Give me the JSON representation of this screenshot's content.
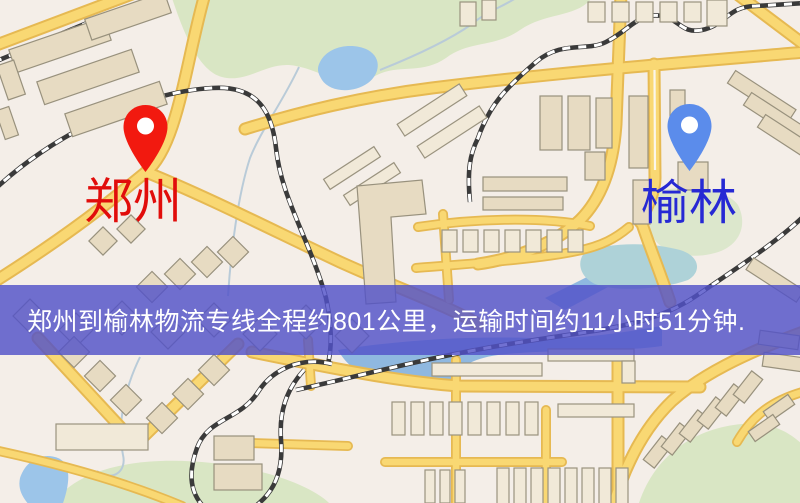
{
  "banner": {
    "text": "郑州到榆林物流专线全程约801公里，运输时间约11小时51分钟.",
    "background_color": "#5252c8",
    "text_color": "#ffffff"
  },
  "markers": [
    {
      "id": "origin",
      "label": "郑州",
      "pin_color": "#f2190f",
      "label_color": "#e10d0b"
    },
    {
      "id": "destination",
      "label": "榆林",
      "pin_color": "#5b8ceb",
      "label_color": "#2629d4"
    }
  ],
  "map_palette": {
    "background": "#f4eee8",
    "road_fill": "#f9d873",
    "road_casing": "#e6b952",
    "park_green": "#d9e6c4",
    "water_blue": "#9cc5e9",
    "teal_water": "#aed2d8",
    "building_tan": "#e7dbc2",
    "railway_dark": "#3a3a3a"
  }
}
